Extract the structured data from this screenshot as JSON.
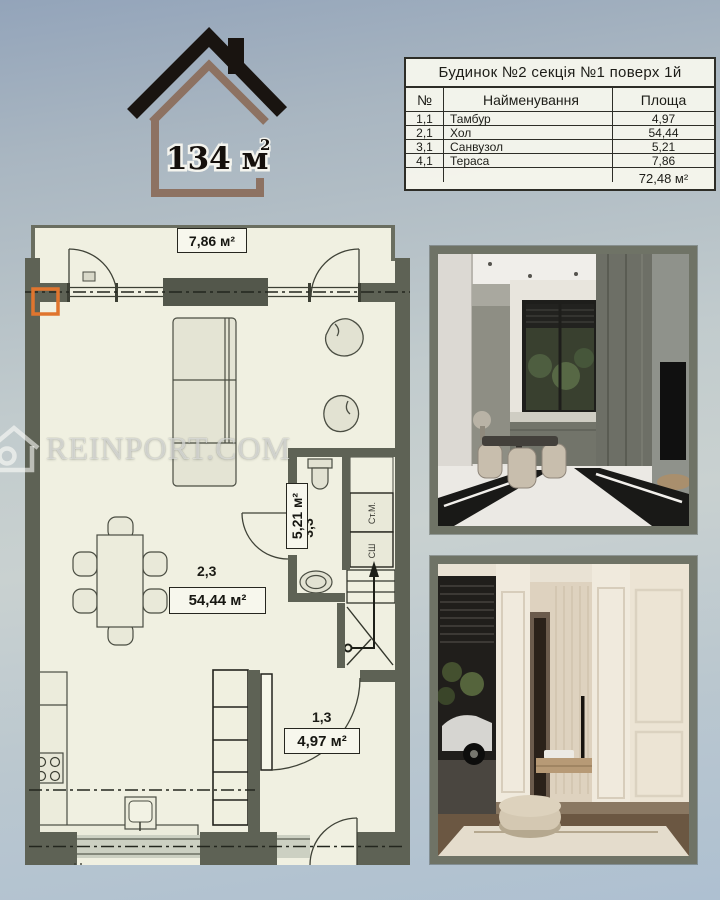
{
  "logo": {
    "area": "134 м",
    "sup": "2"
  },
  "table": {
    "title": "Будинок №2 секція №1 поверх 1й",
    "col_num": "№",
    "col_name": "Найменування",
    "col_area": "Площа",
    "rows": [
      {
        "num": "1,1",
        "name": "Тамбур",
        "area": "4,97"
      },
      {
        "num": "2,1",
        "name": "Хол",
        "area": "54,44"
      },
      {
        "num": "3,1",
        "name": "Санвузол",
        "area": "5,21"
      },
      {
        "num": "4,1",
        "name": "Тераса",
        "area": "7,86"
      }
    ],
    "total": "72,48 м²"
  },
  "plan": {
    "terrace_area": "7,86 м²",
    "hall_no": "2,3",
    "hall_area": "54,44 м²",
    "bath_no": "3,3",
    "bath_area": "5,21 м²",
    "tambour_no": "1,3",
    "tambour_area": "4,97 м²",
    "washer": "Ст.М.",
    "dryer": "СШ"
  },
  "watermark": {
    "text": "REINPORT.COM"
  },
  "colors": {
    "wall": "#5e6255",
    "paper": "#f0f0e1",
    "accent_marker": "#e0752e",
    "photo_border": "#6f7366",
    "logo_black": "#191410",
    "logo_brown": "#8d7262"
  }
}
